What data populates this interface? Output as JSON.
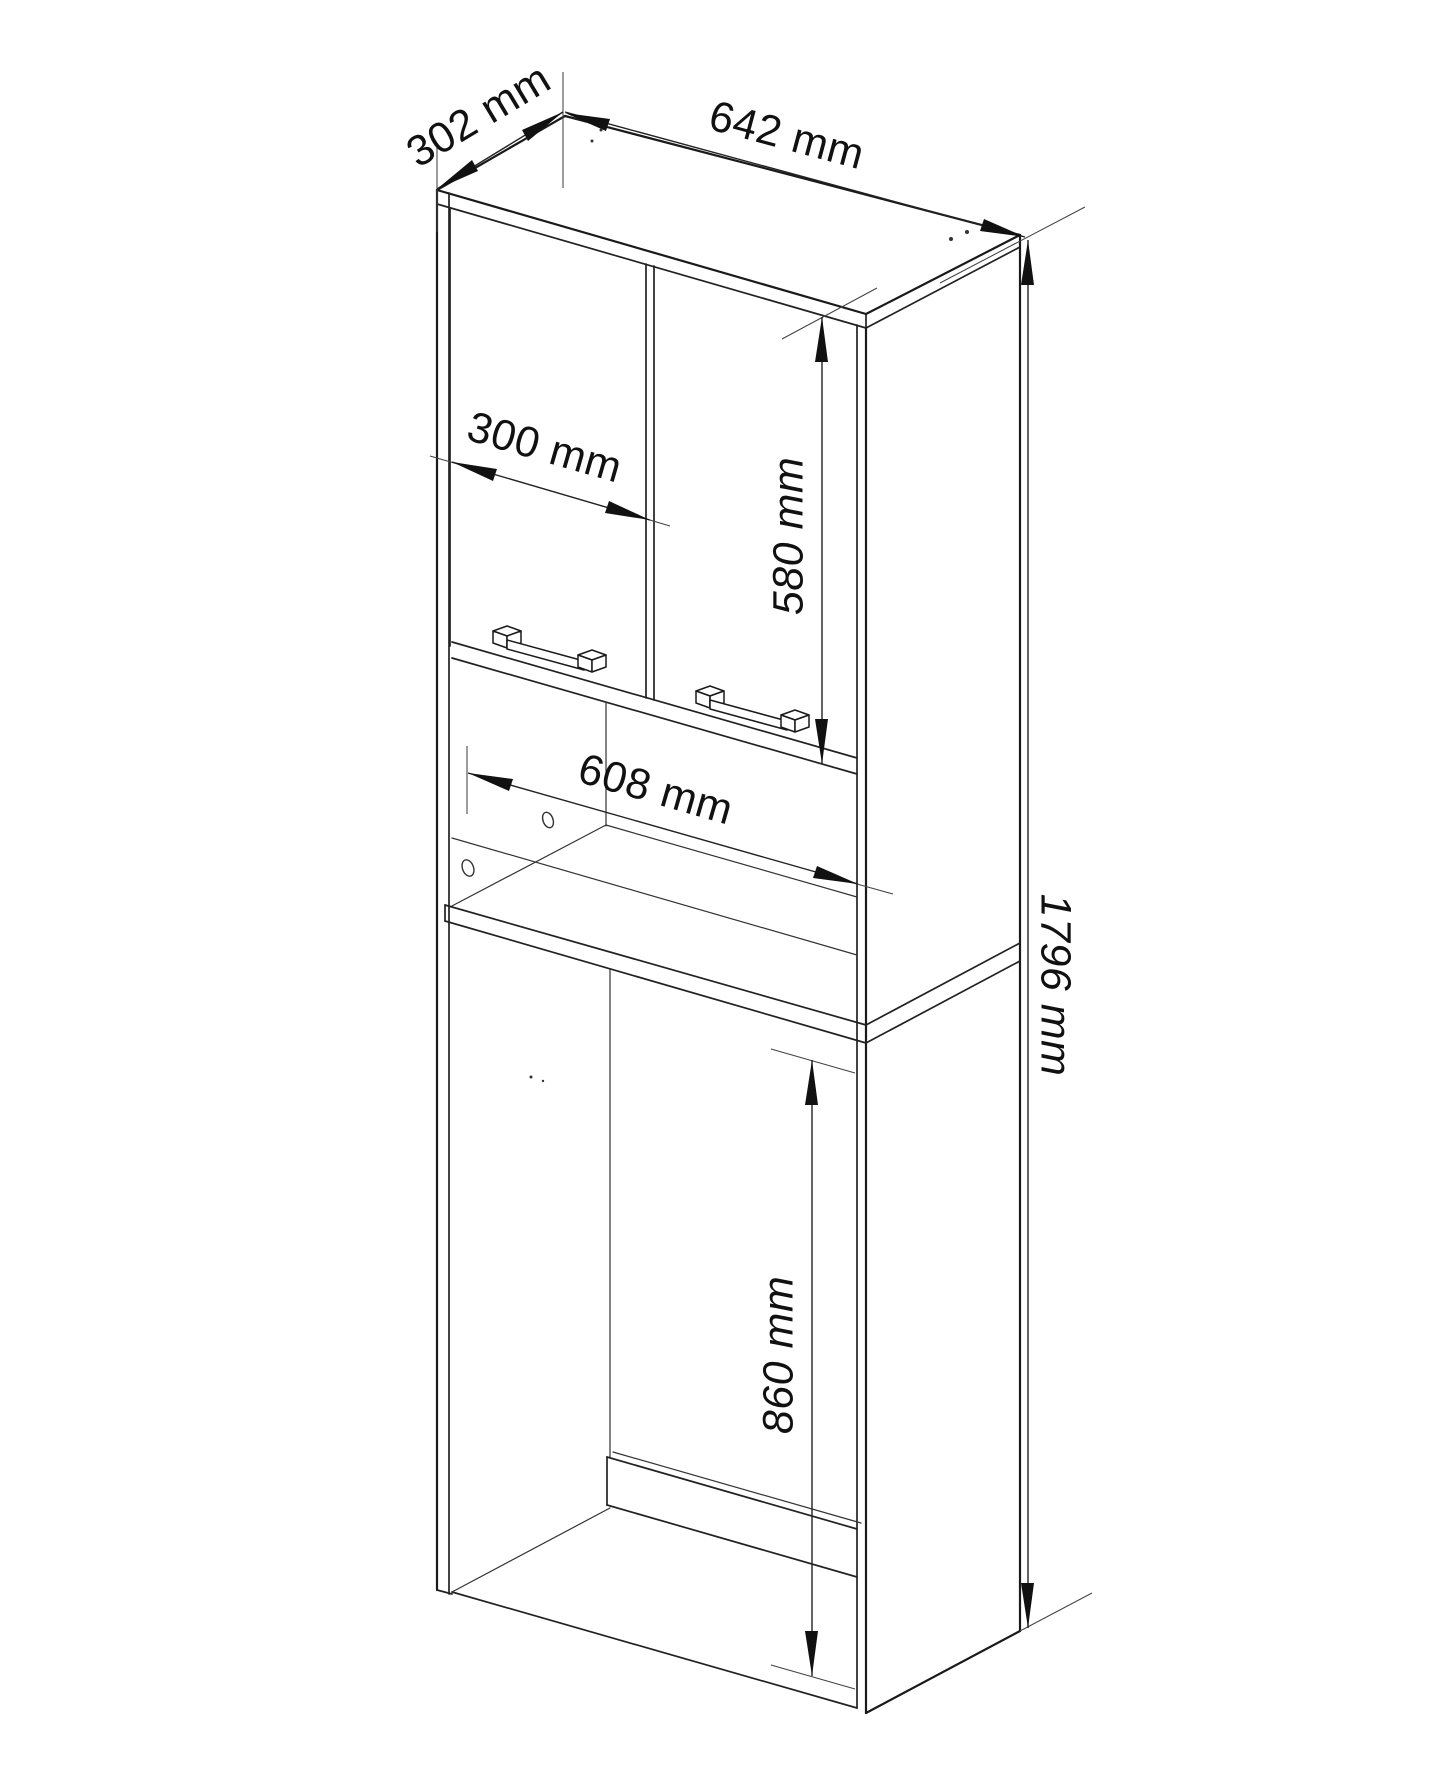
{
  "diagram": {
    "kind": "furniture-technical-drawing",
    "dimension_labels": {
      "top_depth": "302 mm",
      "top_width": "642 mm",
      "door_width": "300 mm",
      "door_height": "580 mm",
      "inner_width": "608 mm",
      "overall_height": "1796 mm",
      "appliance_opening_height": "860 mm"
    },
    "colors": {
      "line": "#1a1a1a",
      "background": "#ffffff",
      "text": "#111111"
    }
  }
}
